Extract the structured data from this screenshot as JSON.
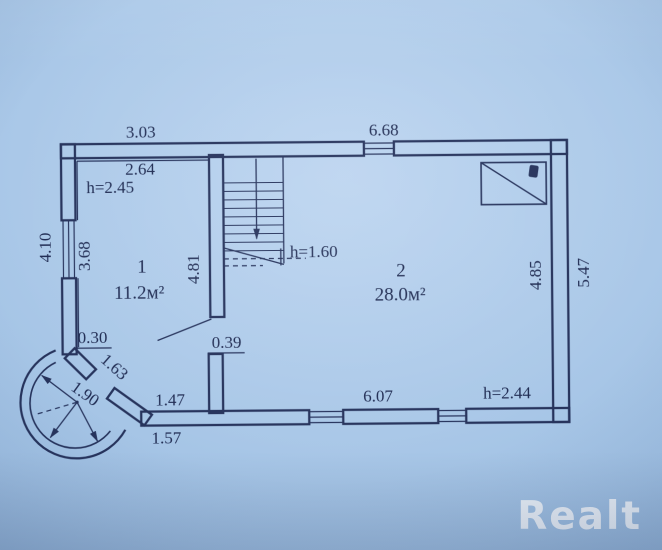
{
  "colors": {
    "ink": "#26335c",
    "paper": "#a6c4e5",
    "watermark": "rgba(255,255,255,0.78)"
  },
  "watermark": {
    "logo_text": "Realt"
  },
  "rooms": [
    {
      "number": "1",
      "area": "11.2м²",
      "ceiling": "h=2.45"
    },
    {
      "number": "2",
      "area": "28.0м²",
      "ceiling": "h=2.44"
    }
  ],
  "stairs": {
    "headroom": "h=1.60"
  },
  "dims": {
    "top_room1": "3.03",
    "top_room2": "6.68",
    "room1_inner_width": "2.64",
    "left_outer": "4.10",
    "left_inner": "3.68",
    "stair_wall": "4.81",
    "right_inner": "4.85",
    "right_outer": "5.47",
    "bay_stub": "0.30",
    "bay_chord": "1.63",
    "bay_radius": "1.90",
    "bottom_left": "1.47",
    "wall_stub": "0.39",
    "bay_outer": "1.57",
    "bottom_room2": "6.07"
  },
  "symbols": {
    "vent_hatch": "crossed-rectangle-flue-symbol"
  }
}
